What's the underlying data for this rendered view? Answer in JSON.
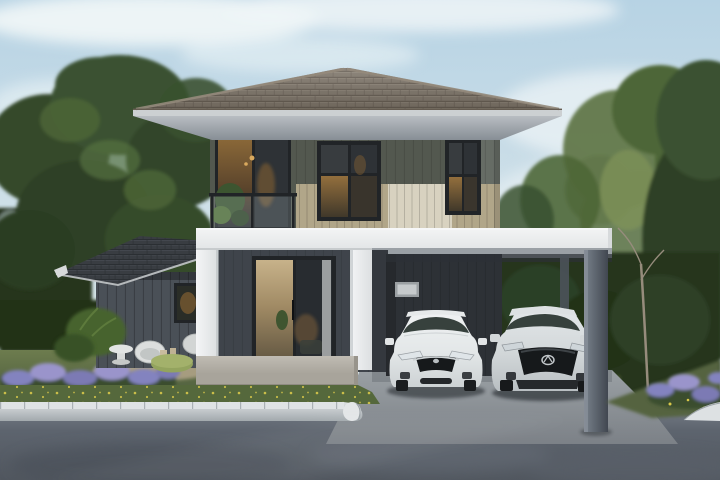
{
  "scene": {
    "type": "architectural-render",
    "description": "Photorealistic exterior render of a modern two-story house with a gray-brown hip tile roof, khaki and dark gray siding, a white portico entrance with glass sliding doors, a lit balcony, an attached flat-roof carport sheltering a white sedan and a silver compact SUV, landscaped garden with lavender flower beds, lawn, large trees, a paver curb and a gray asphalt driveway under a soft blue sky",
    "elements": {
      "sky": {
        "label": "soft blue sky with light clouds"
      },
      "left_tree": {
        "label": "large leafy tree on the left"
      },
      "right_trees": {
        "label": "trees and hedge on the right"
      },
      "main_house": {
        "label": "two-story house facade"
      },
      "main_roof": {
        "label": "hip roof with gray-brown tiles"
      },
      "balcony": {
        "label": "second-floor balcony with glass railing and warm lit door"
      },
      "center_window": {
        "label": "second-floor center window, interior lit"
      },
      "right_window": {
        "label": "second-floor right window"
      },
      "entrance": {
        "label": "white portico entrance with glass sliding door"
      },
      "carport": {
        "label": "attached carport with dark rear wall and gray column"
      },
      "wing": {
        "label": "single-story side wing with dark gable roof"
      },
      "garden": {
        "label": "garden with ferns, white chairs, green pouf table and lavender bed"
      },
      "driveway": {
        "label": "gray asphalt driveway with light concrete apron and paver curb"
      }
    },
    "cars": [
      {
        "label": "white sedan parked in carport",
        "body_color": "#e9ebec"
      },
      {
        "label": "silver compact SUV parked in carport",
        "body_color": "#d6dadc"
      }
    ],
    "colors": {
      "sky_top": "#b7d3e4",
      "sky_mid": "#cddfe8",
      "sky_low": "#e5edec",
      "cloud": "#eff5f7",
      "tree_dark": "#2e4126",
      "tree": "#3a5130",
      "tree_light": "#4e6637",
      "tree_lighter": "#61774a",
      "tree_pale": "#7e9258",
      "hedge": "#26351f",
      "hedge_dark": "#223019",
      "trunk": "#6e655a",
      "trunk_light": "#968c7c",
      "lawn_top": "#6d7c4e",
      "lawn_bottom": "#556441",
      "lawn_dark": "#46582f",
      "grass_strip": "#55683c",
      "flower_purple": "#8383bf",
      "flower_purple_light": "#9a94cb",
      "flower_purple_dark": "#7b7ab4",
      "flower_green": "#3b4e2f",
      "flower_yellow": "#d9c84a",
      "sand": "#b3a58a",
      "roof": "#7d7468",
      "roof_dark": "#655c51",
      "roof_light": "#948a7c",
      "fascia": "#ccd0d2",
      "soffit_top": "#b8bdc2",
      "soffit_bottom": "#878e95",
      "wall_upper": "#53584f",
      "wall_upper_light": "#6a7068",
      "siding": "#b1a689",
      "siding_cream": "#d8d2c0",
      "frame": "#212427",
      "glass_dark": "#2e3236",
      "glass_mid": "#383c3f",
      "warm": "#7c5c31",
      "warm_mid": "#8a6838",
      "warm_deep": "#5c452c",
      "warm_glow": "#c99f58",
      "band_top": "#f3f4f5",
      "band_bottom": "#e2e5e6",
      "band_under": "#c7cbcd",
      "band_shadow": "#9aa0a5",
      "white_col_a": "#f4f5f6",
      "white_col_b": "#dcdfe1",
      "white_col_edge": "#b9bec1",
      "wall_first": "#3f444b",
      "wall_first_dark": "#34383e",
      "carport_wall": "#2d3136",
      "carport_wall_dark": "#24282c",
      "vent_frame": "#9ba0a3",
      "vent_inner": "#c6cacc",
      "col_a": "#79828c",
      "col_b": "#414750",
      "wing_roof": "#393d42",
      "wing_roof_dark": "#2b2f33",
      "wing_roof_hl": "#4a4f55",
      "wing_wall": "#4a5057",
      "terrace_a": "#c0bcb3",
      "terrace_b": "#a5a198",
      "terrace_face": "#a8a49b",
      "interior_floor": "#6e6455",
      "apron_a": "#9aa0a4",
      "apron_b": "#7c8187",
      "curb_a": "#dde1e3",
      "curb_b": "#a2a9ad",
      "curb_joint": "#aab1b5",
      "curb_cap": "#e3e6e7",
      "road_a": "#727983",
      "road_b": "#5d646e",
      "road_c": "#51575f",
      "car_white_a": "#f0f2f3",
      "car_white_b": "#cdd2d4",
      "car_silver_a": "#e4e8ea",
      "car_silver_b": "#b9bfc2",
      "car_glass": "#37413d",
      "car_dark": "#16191b",
      "chrome": "#cdd2d4",
      "shadow": "#1f2327",
      "white_furniture": "#dcdedd",
      "pouf": "#93a35e"
    }
  }
}
